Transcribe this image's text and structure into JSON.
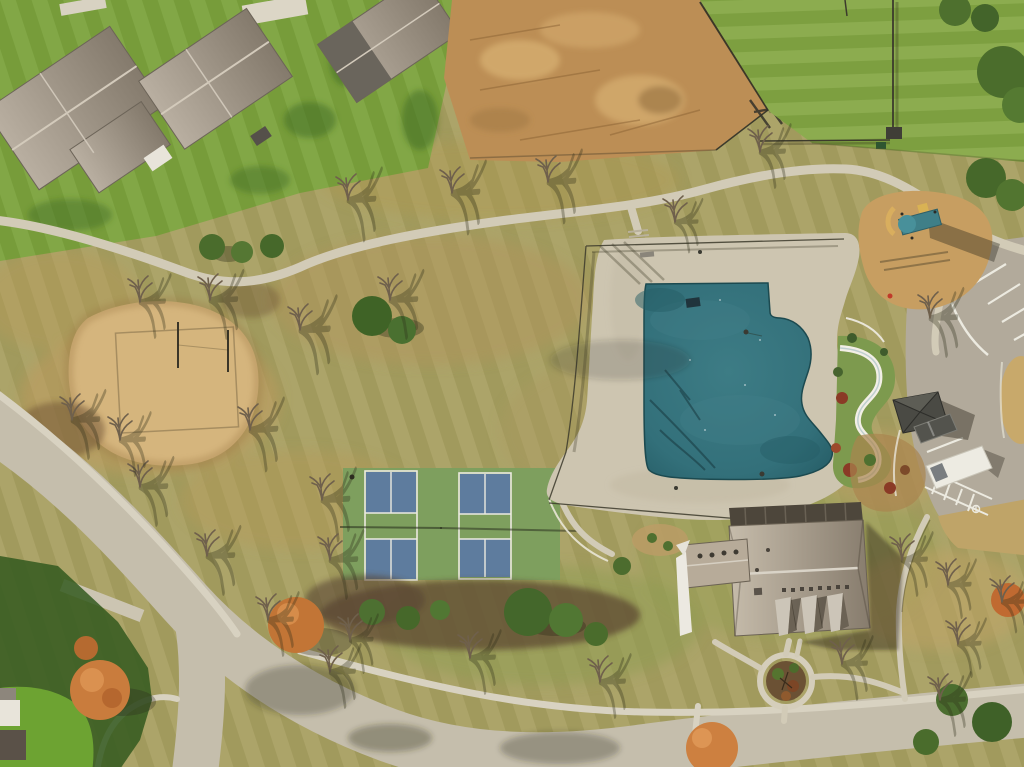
{
  "scene": {
    "description": "Aerial drone photograph of a residential community amenity park in autumn: covered swimming pool with concrete deck and water slide, clubhouse, two pickleball courts, sand volleyball court, playground, pavilion and parking lot with a white van, surrounded by curving streets, walking paths, houses and bare trees with long shadows",
    "season": "late autumn",
    "view": "top-down aerial",
    "width_px": 1024,
    "height_px": 767
  },
  "features": {
    "pool": "Swimming pool with teal winter cover",
    "pool_deck": "Concrete pool deck with black fence",
    "water_slide": "White winding water slide with landscaping",
    "clubhouse": "Clubhouse with gray shingled roof and three dormers",
    "pickleball_courts": "Two green pickleball courts with blue service areas",
    "sand_court": "Sand volleyball court",
    "playground": "Playground with teal slide on mulch bed",
    "pavilion": "Small pavilion with dark pyramidal roof",
    "parking_lot": "Parking lot with white van, gray car and striped stalls",
    "walking_path": "Looping concrete walking path",
    "streets": "Curving residential streets with sidewalks",
    "houses": "Houses with gray hip roofs and green lawns",
    "dirt_lot": "Graded dirt construction lot with fence",
    "trees": "Bare deciduous trees, evergreen clusters and orange autumn trees"
  },
  "palette": {
    "lawn_green": "#7ba23d",
    "lawn_green_ne": "#83a644",
    "lawn_dark": "#3e6a26",
    "field_tan": "#a89f62",
    "field_brown": "#bf9a5c",
    "field_green": "#8f9c52",
    "dirt_brown": "#bc8e55",
    "dirt_light": "#d9b273",
    "sand_tan": "#d5b57d",
    "mulch_dark": "#584430",
    "path_concrete": "#d2cbb7",
    "sidewalk_concrete": "#d8d2c1",
    "road_asphalt": "#c5beac",
    "parking_asphalt": "#b2aa9b",
    "deck_concrete": "#cdc5b0",
    "pool_teal": "#36747d",
    "pool_teal_dark": "#265d66",
    "court_green": "#7e9f5e",
    "court_blue": "#5e7c9e",
    "line_white": "#eceae0",
    "roof_light": "#b6ac9e",
    "roof_dark": "#877d6f",
    "clubhouse_roof_light": "#c3b9a8",
    "clubhouse_roof_dark": "#8a7f70",
    "wall_white": "#ece9e1",
    "pavilion_gray": "#4a4a44",
    "van_white": "#edebe2",
    "car_gray": "#53534d",
    "tree_orange": "#c97c3d",
    "tree_green": "#4a6c2c",
    "tree_bare": "#6f604c",
    "slide_teal": "#3f7f88",
    "water_slide_white": "#f2efe6"
  }
}
